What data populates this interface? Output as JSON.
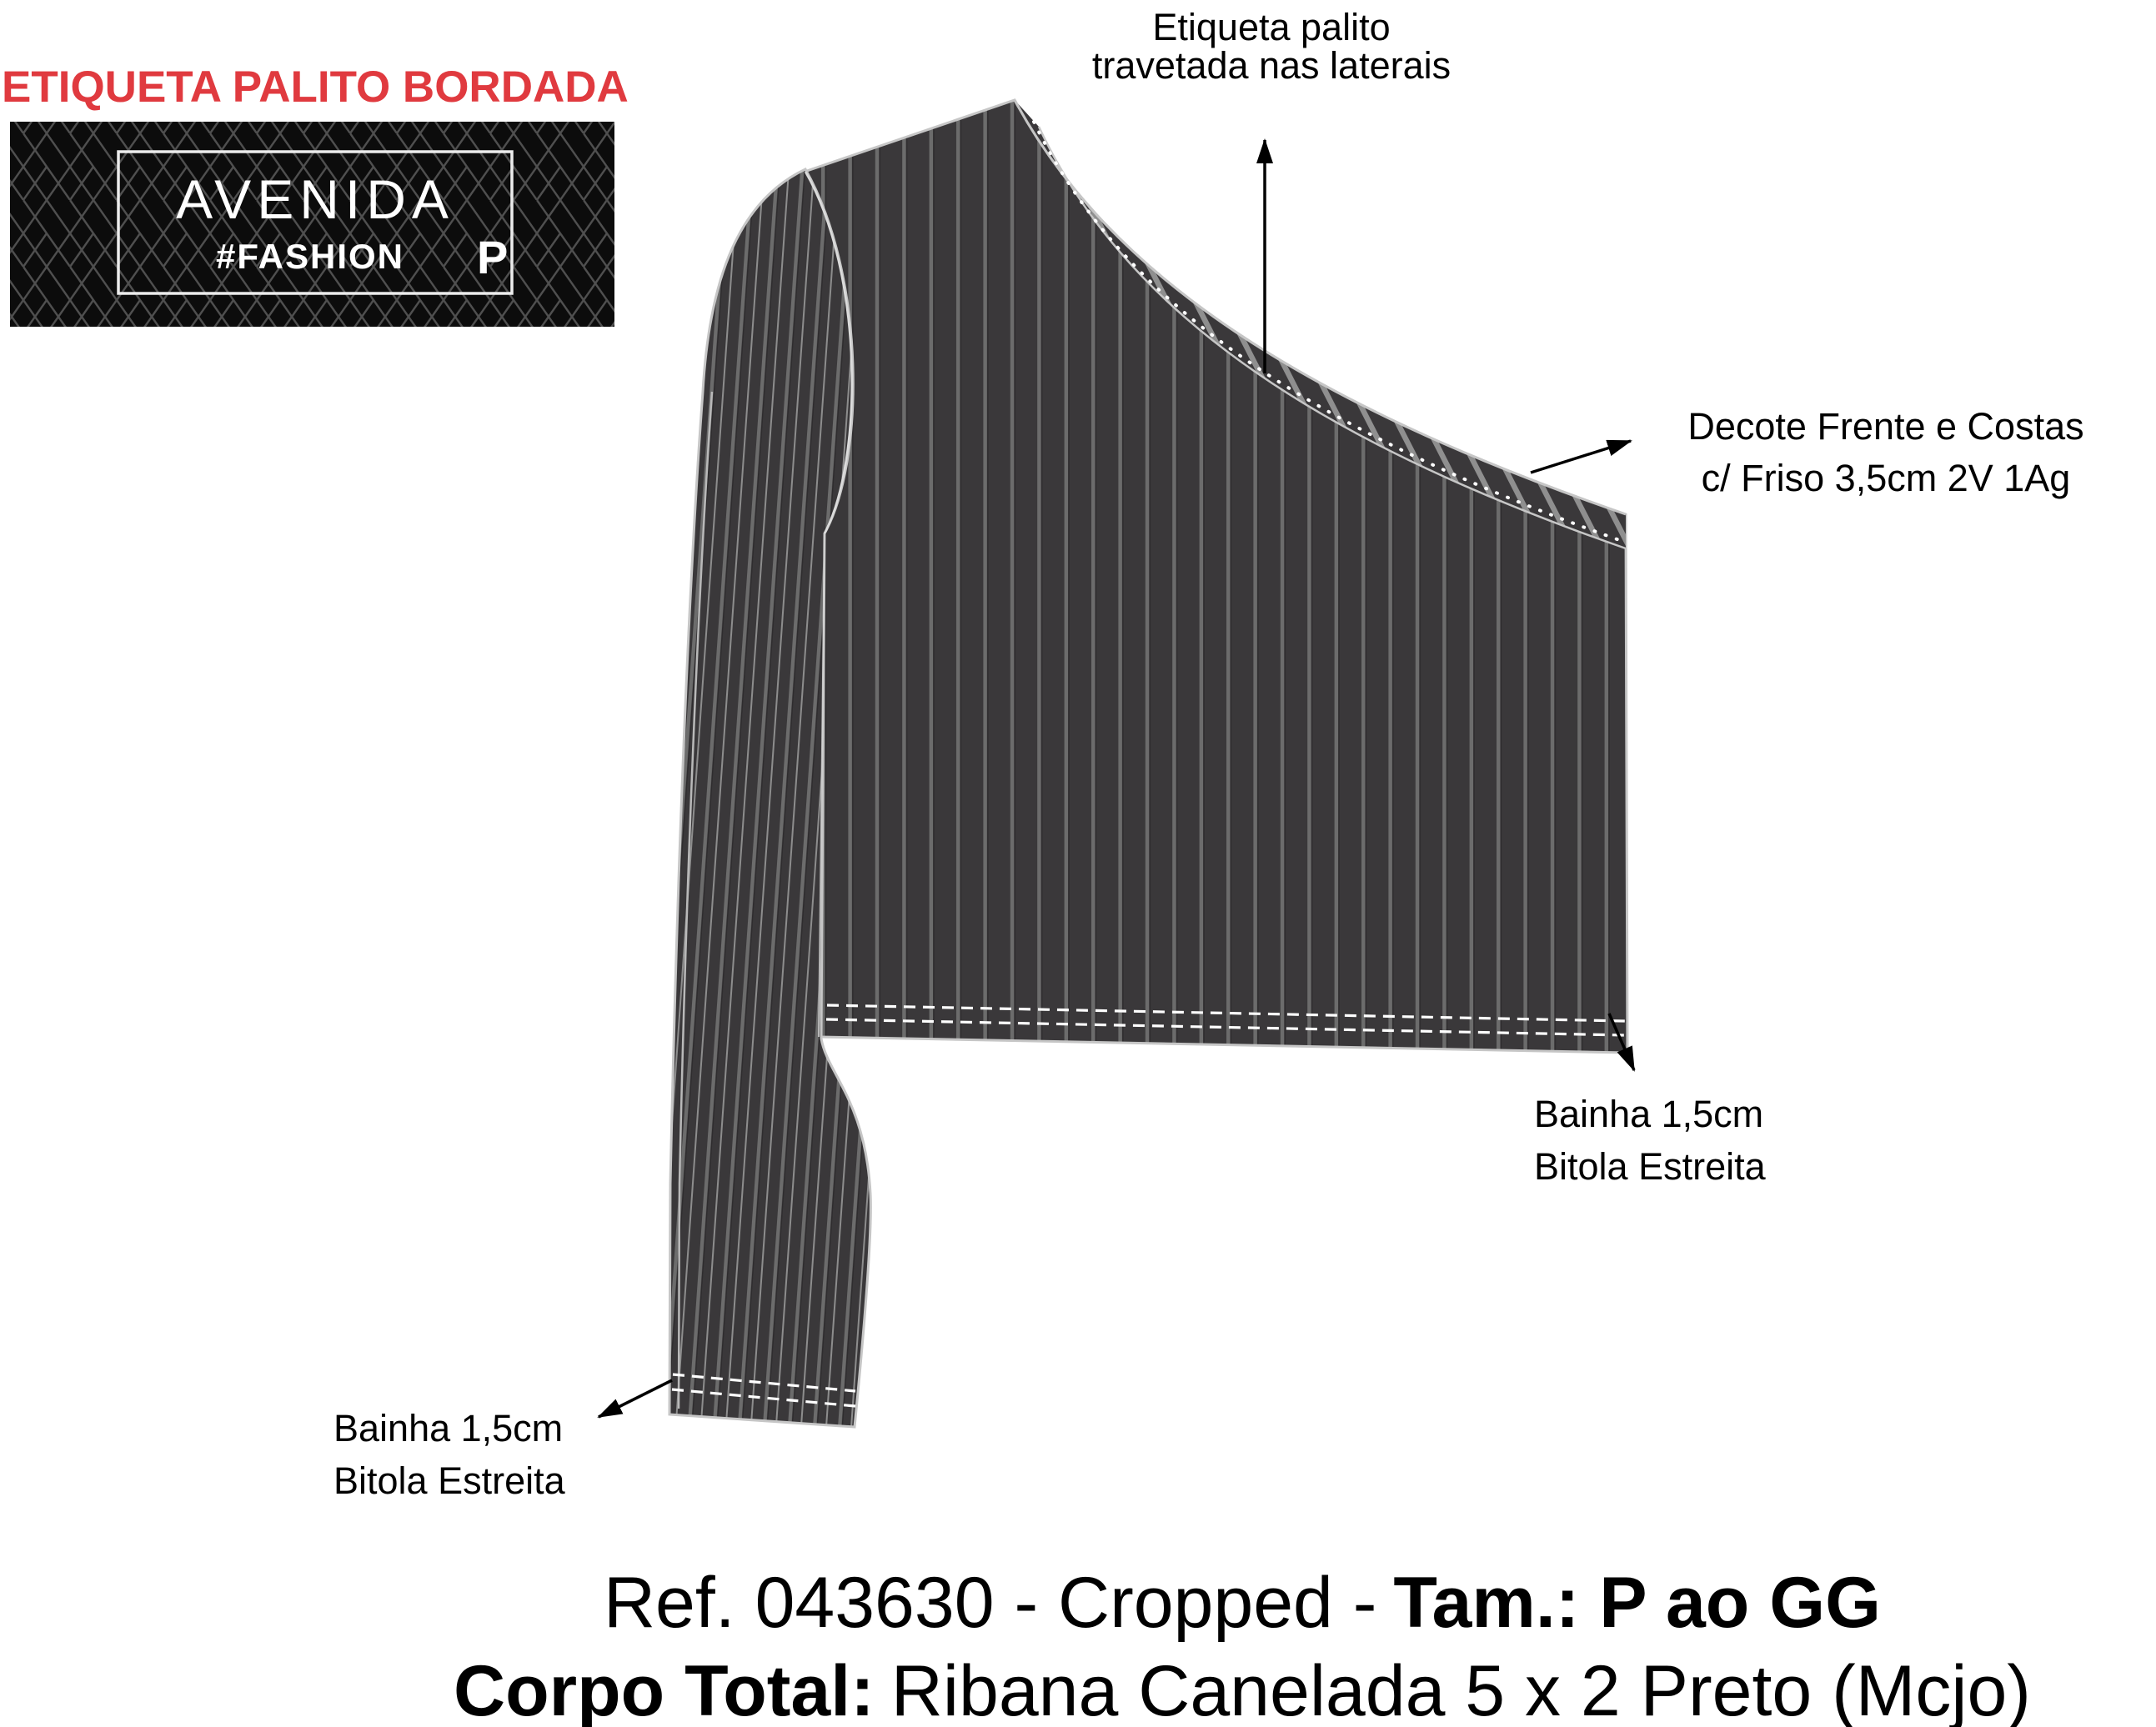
{
  "header": {
    "title": "ETIQUETA PALITO BORDADA"
  },
  "label_tag": {
    "brand": "AVENIDA",
    "hashtag": "#FASHION",
    "size_letter": "P"
  },
  "annotations": {
    "top_label": {
      "line1": "Etiqueta palito",
      "line2": "travetada nas laterais"
    },
    "neckline": {
      "line1": "Decote Frente e Costas",
      "line2": "c/ Friso 3,5cm 2V 1Ag"
    },
    "hem_right": {
      "line1": "Bainha 1,5cm",
      "line2": "Bitola Estreita"
    },
    "hem_left": {
      "line1": "Bainha 1,5cm",
      "line2": "Bitola Estreita"
    }
  },
  "caption": {
    "line1_regular": "Ref. 043630 - Cropped -",
    "line1_bold": "Tam.: P ao GG",
    "line2_bold": "Corpo Total:",
    "line2_regular": "Ribana Canelada 5 x 2 Preto (Mcjo)"
  },
  "colors": {
    "accent_red": "#e03a3f",
    "fabric_dark": "#3a383a",
    "stripe_gray": "#6c6c6c",
    "stripe_light": "#8d8d8d",
    "band_hatch": "#8f8f8f",
    "stitch_white": "#ffffff",
    "edge_light": "#c6c6c6",
    "label_black": "#0c0c0c",
    "lattice_gray": "#4f4f4f",
    "label_border": "#ececec",
    "text_black": "#000000"
  }
}
